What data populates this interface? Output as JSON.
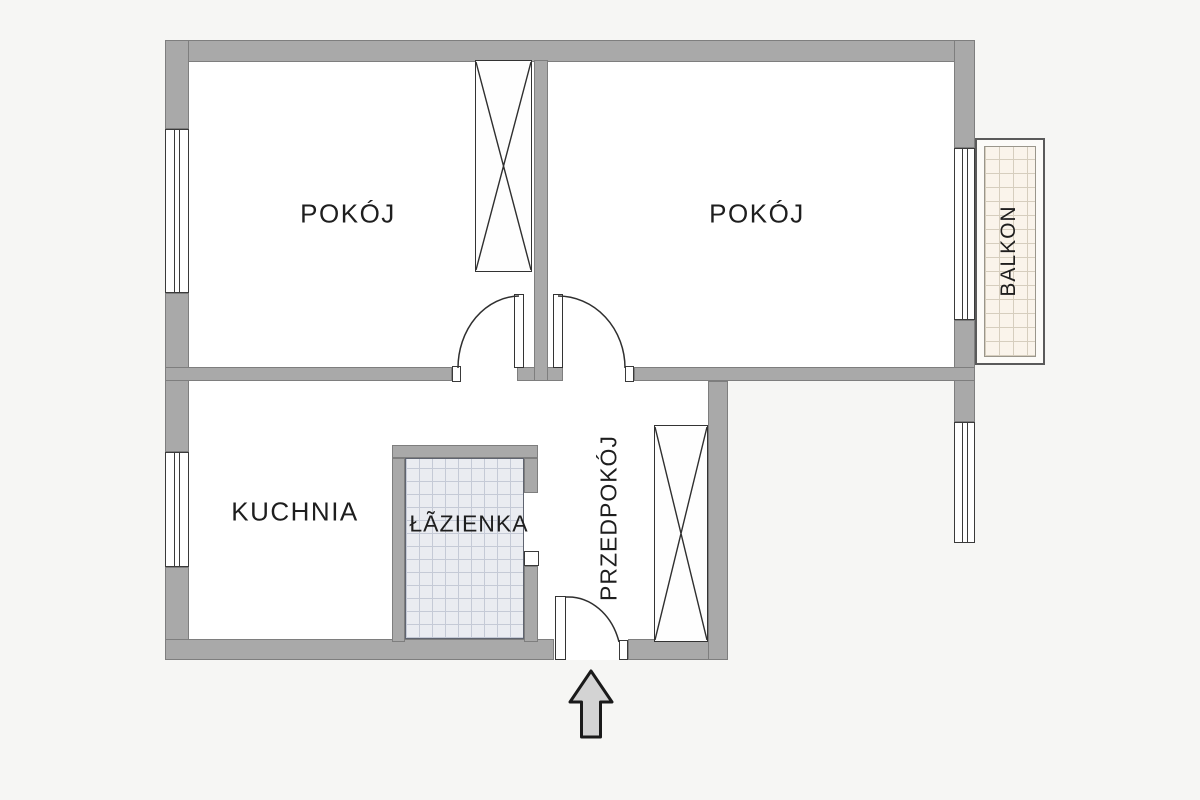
{
  "scene": {
    "type": "apartment-floor-plan",
    "background_color": "#f6f6f4",
    "floor_color": "#ffffff",
    "wall_color": "#a9a9a9",
    "text_color": "#1e1e1e"
  },
  "rooms": [
    {
      "name": "room-1",
      "label": "POKÓJ"
    },
    {
      "name": "room-2",
      "label": "POKÓJ"
    },
    {
      "name": "kitchen",
      "label": "KUCHNIA"
    },
    {
      "name": "bathroom",
      "label": "ŁÃZIENKA"
    },
    {
      "name": "hallway",
      "label": "PRZEDPOKÓJ"
    },
    {
      "name": "balcony",
      "label": "BALKON"
    }
  ],
  "colors": {
    "bathroom_tile": "#eaecf1",
    "bathroom_tile_line": "#c5cad6",
    "balcony_tile": "#faf4eb",
    "balcony_tile_line": "#d6cebe",
    "arrow_fill": "#d3d3d3",
    "arrow_outline": "#1a1a1a",
    "door_line": "#2f2f2f"
  }
}
